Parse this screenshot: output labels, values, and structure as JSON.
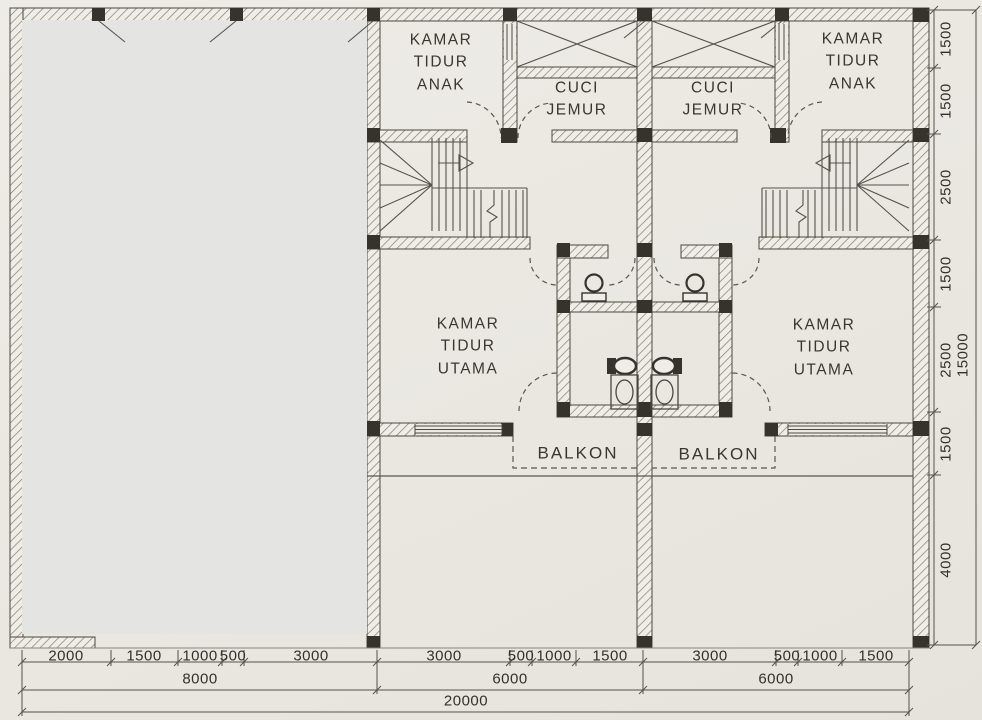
{
  "plan": {
    "rooms": {
      "kamar_tidur_anak_left": "KAMAR\nTIDUR\nANAK",
      "kamar_tidur_anak_right": "KAMAR\nTIDUR\nANAK",
      "cuci_jemur_left": "CUCI\nJEMUR",
      "cuci_jemur_right": "CUCI\nJEMUR",
      "kamar_tidur_utama_left": "KAMAR\nTIDUR\nUTAMA",
      "kamar_tidur_utama_right": "KAMAR\nTIDUR\nUTAMA",
      "balkon_left": "BALKON",
      "balkon_right": "BALKON"
    },
    "dimensions": {
      "bottom_row1": [
        "2000",
        "1500",
        "1000",
        "500",
        "3000",
        "3000",
        "500",
        "1000",
        "1500",
        "3000",
        "500",
        "1000",
        "1500"
      ],
      "bottom_row2": [
        "8000",
        "6000",
        "6000"
      ],
      "bottom_row3": [
        "20000"
      ],
      "right_col": [
        "1500",
        "1500",
        "2500",
        "1500",
        "2500",
        "1500",
        "4000"
      ],
      "right_total": "15000"
    },
    "colors": {
      "paper": "#eae7e1",
      "ink": "#4b483e",
      "column": "#35332c",
      "redaction": "#e4e4e2"
    }
  }
}
